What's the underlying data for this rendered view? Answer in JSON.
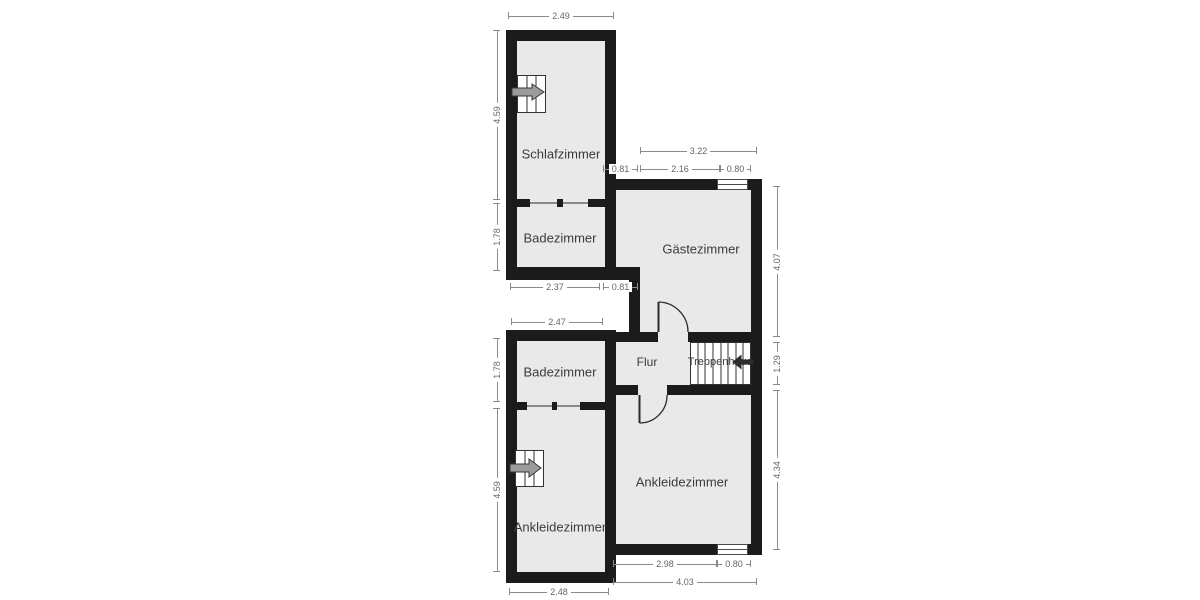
{
  "rooms": {
    "schlafzimmer": "Schlafzimmer",
    "badezimmer_top": "Badezimmer",
    "gaestezimmer": "Gästezimmer",
    "flur": "Flur",
    "treppenhaus": "Treppenhaus",
    "badezimmer_bottom": "Badezimmer",
    "ankleidezimmer_left": "Ankleidezimmer",
    "ankleidezimmer_right": "Ankleidezimmer"
  },
  "dimensions": {
    "schlafzimmer_width": "2.49",
    "schlafzimmer_height": "4.59",
    "badezimmer_top_height": "1.78",
    "badezimmer_top_width": "2.37",
    "corridor_offset": "0.81",
    "gaestezimmer_total_width": "3.22",
    "gaestezimmer_wall_offset": "0.81",
    "gaestezimmer_inner_width": "2.16",
    "gaestezimmer_window_width": "0.80",
    "gaestezimmer_height": "4.07",
    "treppenhaus_height": "1.29",
    "ankleidezimmer_right_height": "4.34",
    "ankleidezimmer_right_inner_width": "2.98",
    "ankleidezimmer_right_window_width": "0.80",
    "ankleidezimmer_right_total_width": "4.03",
    "badezimmer_bottom_height": "1.78",
    "badezimmer_bottom_width": "2.47",
    "ankleidezimmer_left_height": "4.59",
    "ankleidezimmer_left_width": "2.48"
  },
  "icons": {
    "schlafzimmer_stairs": "stairs-arrow-right",
    "ankleidezimmer_stairs": "stairs-arrow-right",
    "treppenhaus_stairs": "stairs-arrow-left"
  },
  "colors": {
    "wall": "#1b1b1b",
    "floor": "#e9e9e9",
    "background": "#ffffff",
    "dimension_line": "#8a8a8a",
    "dimension_text": "#666666",
    "room_label": "#3b3b3b",
    "stair_line": "#333333",
    "arrow_fill_gray": "#9b9b9b",
    "arrow_fill_dark": "#2d2d2d"
  }
}
